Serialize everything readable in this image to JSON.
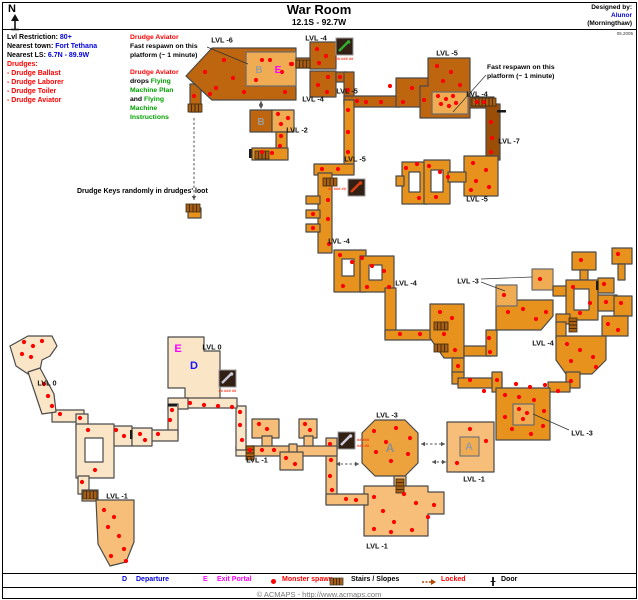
{
  "colors": {
    "blue": "#0000dd",
    "red": "#ff0000",
    "green": "#00a000",
    "magenta": "#ff00ff",
    "spawn": "#ff0000",
    "room_brown": "#BD650F",
    "room_dark": "#9A4E06",
    "room_orange": "#E8921E",
    "room_light": "#F0AC52",
    "room_lvl1": "#F6BE79",
    "room_cream": "#FAE5C6"
  },
  "header": {
    "compass": "N",
    "title": "War Room",
    "coords": "12.1S - 92.7W",
    "designed_by_label": "Designed by:",
    "designer": "Alunor",
    "designer_world": "(Morningthaw)",
    "date": "05.2005"
  },
  "info_panel": {
    "lvl_restriction_label": "Lvl Restriction:",
    "lvl_restriction": "80+",
    "nearest_town_label": "Nearest town:",
    "nearest_town": "Fort Tethana",
    "nearest_ls_label": "Nearest LS:",
    "nearest_ls": "6.7N - 89.9W",
    "drudges_header": "Drudges:",
    "drudges": [
      "- Drudge Ballast",
      "- Drudge Laborer",
      "- Drudge Toiler",
      "- Drudge Aviator"
    ]
  },
  "annotations": {
    "aviator_respawn": {
      "title": "Drudge Aviator",
      "line1": "Fast respawn on this",
      "line2": "platform (~ 1 minute)"
    },
    "aviator_drops": {
      "title": "Drudge Aviator",
      "l1_black": "drops",
      "l1_green": "Flying",
      "l2_green": "Machine Plan",
      "l3_black": "and",
      "l3_green": "Flying",
      "l4_green": "Machine",
      "l5_green": "Instructions"
    },
    "respawn_right": {
      "line1": "Fast respawn on this",
      "line2": "platform (~ 1 minute)"
    },
    "drudge_keys": "Drudge Keys randomly in drudges' loot"
  },
  "map": {
    "labels": [
      {
        "t": "LVL -6",
        "x": 222,
        "y": 40
      },
      {
        "t": "LVL -4",
        "x": 316,
        "y": 38
      },
      {
        "t": "LVL -4",
        "x": 313,
        "y": 99
      },
      {
        "t": "LVL -5",
        "x": 347,
        "y": 91
      },
      {
        "t": "LVL -5",
        "x": 447,
        "y": 53
      },
      {
        "t": "LVL -4",
        "x": 477,
        "y": 94
      },
      {
        "t": "LVL -7",
        "x": 509,
        "y": 141
      },
      {
        "t": "LVL -5",
        "x": 477,
        "y": 199
      },
      {
        "t": "LVL -5",
        "x": 355,
        "y": 159
      },
      {
        "t": "LVL -2",
        "x": 297,
        "y": 130
      },
      {
        "t": "LVL -4",
        "x": 339,
        "y": 241
      },
      {
        "t": "LVL -4",
        "x": 406,
        "y": 283
      },
      {
        "t": "LVL -3",
        "x": 468,
        "y": 281
      },
      {
        "t": "LVL -4",
        "x": 543,
        "y": 343
      },
      {
        "t": "LVL 0",
        "x": 212,
        "y": 347
      },
      {
        "t": "LVL 0",
        "x": 47,
        "y": 383
      },
      {
        "t": "LVL -3",
        "x": 387,
        "y": 415
      },
      {
        "t": "LVL -3",
        "x": 582,
        "y": 433
      },
      {
        "t": "LVL -1",
        "x": 257,
        "y": 460
      },
      {
        "t": "LVL -1",
        "x": 474,
        "y": 479
      },
      {
        "t": "LVL -1",
        "x": 117,
        "y": 496
      },
      {
        "t": "LVL -1",
        "x": 377,
        "y": 546
      }
    ],
    "markers": [
      {
        "t": "B",
        "x": 259,
        "y": 73,
        "c": "#9c9c9c",
        "s": 10
      },
      {
        "t": "E",
        "x": 278,
        "y": 73,
        "c": "#ff00ff",
        "s": 10
      },
      {
        "t": "B",
        "x": 261,
        "y": 125,
        "c": "#9c9c9c",
        "s": 10
      },
      {
        "t": "E",
        "x": 178,
        "y": 352,
        "c": "#ff00ff",
        "s": 11
      },
      {
        "t": "D",
        "x": 194,
        "y": 369,
        "c": "#1414ff",
        "s": 11
      },
      {
        "t": "A",
        "x": 390,
        "y": 452,
        "c": "#8f8f8f",
        "s": 12
      },
      {
        "t": "A",
        "x": 469,
        "y": 450,
        "c": "#9c9c9c",
        "s": 11
      }
    ],
    "icons": [
      {
        "name": "flying-machine-plan-icon",
        "x": 336,
        "y": 38,
        "c": "#2fae2f",
        "note": "## ### ##",
        "np": "b"
      },
      {
        "name": "item-icon",
        "x": 348,
        "y": 179,
        "c": "#e04010",
        "note": "## ### ##",
        "np": "l"
      },
      {
        "name": "item-icon",
        "x": 219,
        "y": 370,
        "c": "#c9c9d9",
        "note": "## ### ##",
        "np": "b"
      },
      {
        "name": "item-icon",
        "x": 338,
        "y": 432,
        "c": "#d0d0e0",
        "note": "## ###",
        "note2": "### ##",
        "np": "r"
      }
    ],
    "stairs": [
      [
        296,
        60,
        "h"
      ],
      [
        188,
        104,
        "h"
      ],
      [
        186,
        204,
        "h"
      ],
      [
        255,
        151,
        "h"
      ],
      [
        472,
        98,
        "h"
      ],
      [
        482,
        98,
        "h"
      ],
      [
        323,
        178,
        "h"
      ],
      [
        434,
        322,
        "h"
      ],
      [
        434,
        344,
        "h"
      ],
      [
        396,
        479,
        "v"
      ],
      [
        83,
        491,
        "h"
      ],
      [
        246,
        446,
        "v"
      ],
      [
        569,
        318,
        "v"
      ]
    ],
    "doors": [
      [
        497,
        110,
        "h"
      ],
      [
        596,
        281,
        "v"
      ],
      [
        249,
        149,
        "v"
      ],
      [
        130,
        430,
        "v"
      ],
      [
        168,
        404,
        "h"
      ]
    ],
    "arrows": [
      {
        "x1": 194,
        "y1": 118,
        "x2": 194,
        "y2": 200,
        "d": false
      },
      {
        "x1": 261,
        "y1": 101,
        "x2": 261,
        "y2": 109,
        "d": true
      },
      {
        "x1": 336,
        "y1": 464,
        "x2": 359,
        "y2": 464,
        "d": true
      },
      {
        "x1": 421,
        "y1": 444,
        "x2": 445,
        "y2": 444,
        "d": true
      },
      {
        "x1": 432,
        "y1": 462,
        "x2": 446,
        "y2": 462,
        "d": true
      }
    ],
    "pointers": [
      [
        207,
        47,
        248,
        64
      ],
      [
        486,
        75,
        453,
        112
      ],
      [
        481,
        279,
        532,
        277
      ],
      [
        481,
        282,
        505,
        291
      ],
      [
        569,
        430,
        533,
        414
      ]
    ],
    "spawns": [
      [
        205,
        72
      ],
      [
        216,
        88
      ],
      [
        224,
        60
      ],
      [
        233,
        78
      ],
      [
        244,
        92
      ],
      [
        256,
        80
      ],
      [
        270,
        60
      ],
      [
        285,
        92
      ],
      [
        292,
        64
      ],
      [
        210,
        94
      ],
      [
        194,
        96
      ],
      [
        262,
        60
      ],
      [
        282,
        72
      ],
      [
        291,
        64
      ],
      [
        317,
        49
      ],
      [
        326,
        56
      ],
      [
        319,
        63
      ],
      [
        328,
        77
      ],
      [
        318,
        85
      ],
      [
        327,
        92
      ],
      [
        340,
        77
      ],
      [
        348,
        90
      ],
      [
        357,
        101
      ],
      [
        366,
        102
      ],
      [
        381,
        102
      ],
      [
        390,
        86
      ],
      [
        403,
        102
      ],
      [
        412,
        88
      ],
      [
        424,
        100
      ],
      [
        437,
        66
      ],
      [
        451,
        72
      ],
      [
        443,
        81
      ],
      [
        460,
        85
      ],
      [
        438,
        96
      ],
      [
        446,
        99
      ],
      [
        453,
        96
      ],
      [
        441,
        104
      ],
      [
        449,
        106
      ],
      [
        456,
        103
      ],
      [
        477,
        102
      ],
      [
        484,
        102
      ],
      [
        491,
        122
      ],
      [
        492,
        138
      ],
      [
        491,
        152
      ],
      [
        473,
        163
      ],
      [
        486,
        170
      ],
      [
        476,
        181
      ],
      [
        489,
        187
      ],
      [
        471,
        190
      ],
      [
        406,
        168
      ],
      [
        417,
        164
      ],
      [
        429,
        166
      ],
      [
        440,
        172
      ],
      [
        419,
        198
      ],
      [
        436,
        197
      ],
      [
        448,
        177
      ],
      [
        348,
        110
      ],
      [
        348,
        132
      ],
      [
        348,
        152
      ],
      [
        338,
        169
      ],
      [
        322,
        169
      ],
      [
        328,
        200
      ],
      [
        313,
        214
      ],
      [
        328,
        219
      ],
      [
        313,
        228
      ],
      [
        329,
        244
      ],
      [
        340,
        255
      ],
      [
        352,
        262
      ],
      [
        362,
        258
      ],
      [
        372,
        266
      ],
      [
        384,
        271
      ],
      [
        343,
        286
      ],
      [
        367,
        287
      ],
      [
        389,
        287
      ],
      [
        400,
        334
      ],
      [
        420,
        334
      ],
      [
        440,
        312
      ],
      [
        452,
        318
      ],
      [
        444,
        334
      ],
      [
        455,
        350
      ],
      [
        489,
        338
      ],
      [
        490,
        352
      ],
      [
        504,
        295
      ],
      [
        540,
        279
      ],
      [
        508,
        312
      ],
      [
        523,
        309
      ],
      [
        536,
        319
      ],
      [
        546,
        312
      ],
      [
        581,
        260
      ],
      [
        573,
        287
      ],
      [
        590,
        303
      ],
      [
        580,
        313
      ],
      [
        604,
        284
      ],
      [
        606,
        302
      ],
      [
        618,
        254
      ],
      [
        621,
        303
      ],
      [
        618,
        330
      ],
      [
        608,
        324
      ],
      [
        567,
        344
      ],
      [
        580,
        350
      ],
      [
        593,
        357
      ],
      [
        571,
        361
      ],
      [
        596,
        367
      ],
      [
        571,
        381
      ],
      [
        458,
        366
      ],
      [
        470,
        380
      ],
      [
        484,
        391
      ],
      [
        497,
        380
      ],
      [
        516,
        384
      ],
      [
        530,
        387
      ],
      [
        545,
        385
      ],
      [
        558,
        391
      ],
      [
        505,
        395
      ],
      [
        519,
        397
      ],
      [
        534,
        400
      ],
      [
        544,
        411
      ],
      [
        505,
        417
      ],
      [
        512,
        429
      ],
      [
        531,
        434
      ],
      [
        543,
        426
      ],
      [
        519,
        409
      ],
      [
        527,
        413
      ],
      [
        523,
        419
      ],
      [
        470,
        429
      ],
      [
        457,
        463
      ],
      [
        486,
        441
      ],
      [
        374,
        431
      ],
      [
        396,
        428
      ],
      [
        410,
        438
      ],
      [
        376,
        452
      ],
      [
        391,
        461
      ],
      [
        408,
        454
      ],
      [
        386,
        442
      ],
      [
        374,
        497
      ],
      [
        383,
        511
      ],
      [
        394,
        522
      ],
      [
        374,
        529
      ],
      [
        404,
        494
      ],
      [
        416,
        503
      ],
      [
        434,
        505
      ],
      [
        428,
        517
      ],
      [
        391,
        532
      ],
      [
        412,
        530
      ],
      [
        259,
        424
      ],
      [
        267,
        429
      ],
      [
        305,
        424
      ],
      [
        310,
        430
      ],
      [
        286,
        458
      ],
      [
        295,
        464
      ],
      [
        330,
        444
      ],
      [
        331,
        460
      ],
      [
        330,
        476
      ],
      [
        332,
        490
      ],
      [
        346,
        499
      ],
      [
        356,
        500
      ],
      [
        278,
        114
      ],
      [
        288,
        118
      ],
      [
        281,
        124
      ],
      [
        281,
        136
      ],
      [
        280,
        146
      ],
      [
        262,
        152
      ],
      [
        272,
        153
      ],
      [
        190,
        403
      ],
      [
        204,
        405
      ],
      [
        218,
        406
      ],
      [
        232,
        407
      ],
      [
        240,
        412
      ],
      [
        240,
        425
      ],
      [
        242,
        440
      ],
      [
        250,
        450
      ],
      [
        262,
        450
      ],
      [
        274,
        450
      ],
      [
        158,
        434
      ],
      [
        170,
        420
      ],
      [
        172,
        410
      ],
      [
        116,
        430
      ],
      [
        124,
        436
      ],
      [
        140,
        434
      ],
      [
        145,
        440
      ],
      [
        80,
        418
      ],
      [
        60,
        414
      ],
      [
        88,
        430
      ],
      [
        95,
        470
      ],
      [
        82,
        482
      ],
      [
        24,
        342
      ],
      [
        33,
        346
      ],
      [
        42,
        341
      ],
      [
        22,
        354
      ],
      [
        31,
        357
      ],
      [
        44,
        384
      ],
      [
        48,
        396
      ],
      [
        52,
        406
      ],
      [
        104,
        510
      ],
      [
        114,
        517
      ],
      [
        108,
        527
      ],
      [
        119,
        536
      ],
      [
        124,
        549
      ],
      [
        111,
        556
      ],
      [
        126,
        561
      ]
    ]
  },
  "legend": {
    "departure": {
      "symbol": "D",
      "label": "Departure"
    },
    "exit_portal": {
      "symbol": "E",
      "label": "Exit Portal"
    },
    "monster_spawn": {
      "label": "Monster spawn"
    },
    "stairs": {
      "label": "Stairs / Slopes"
    },
    "locked": {
      "label": "Locked"
    },
    "door": {
      "label": "Door"
    }
  },
  "footer": {
    "copyright": "© ACMAPS - http://www.acmaps.com"
  }
}
